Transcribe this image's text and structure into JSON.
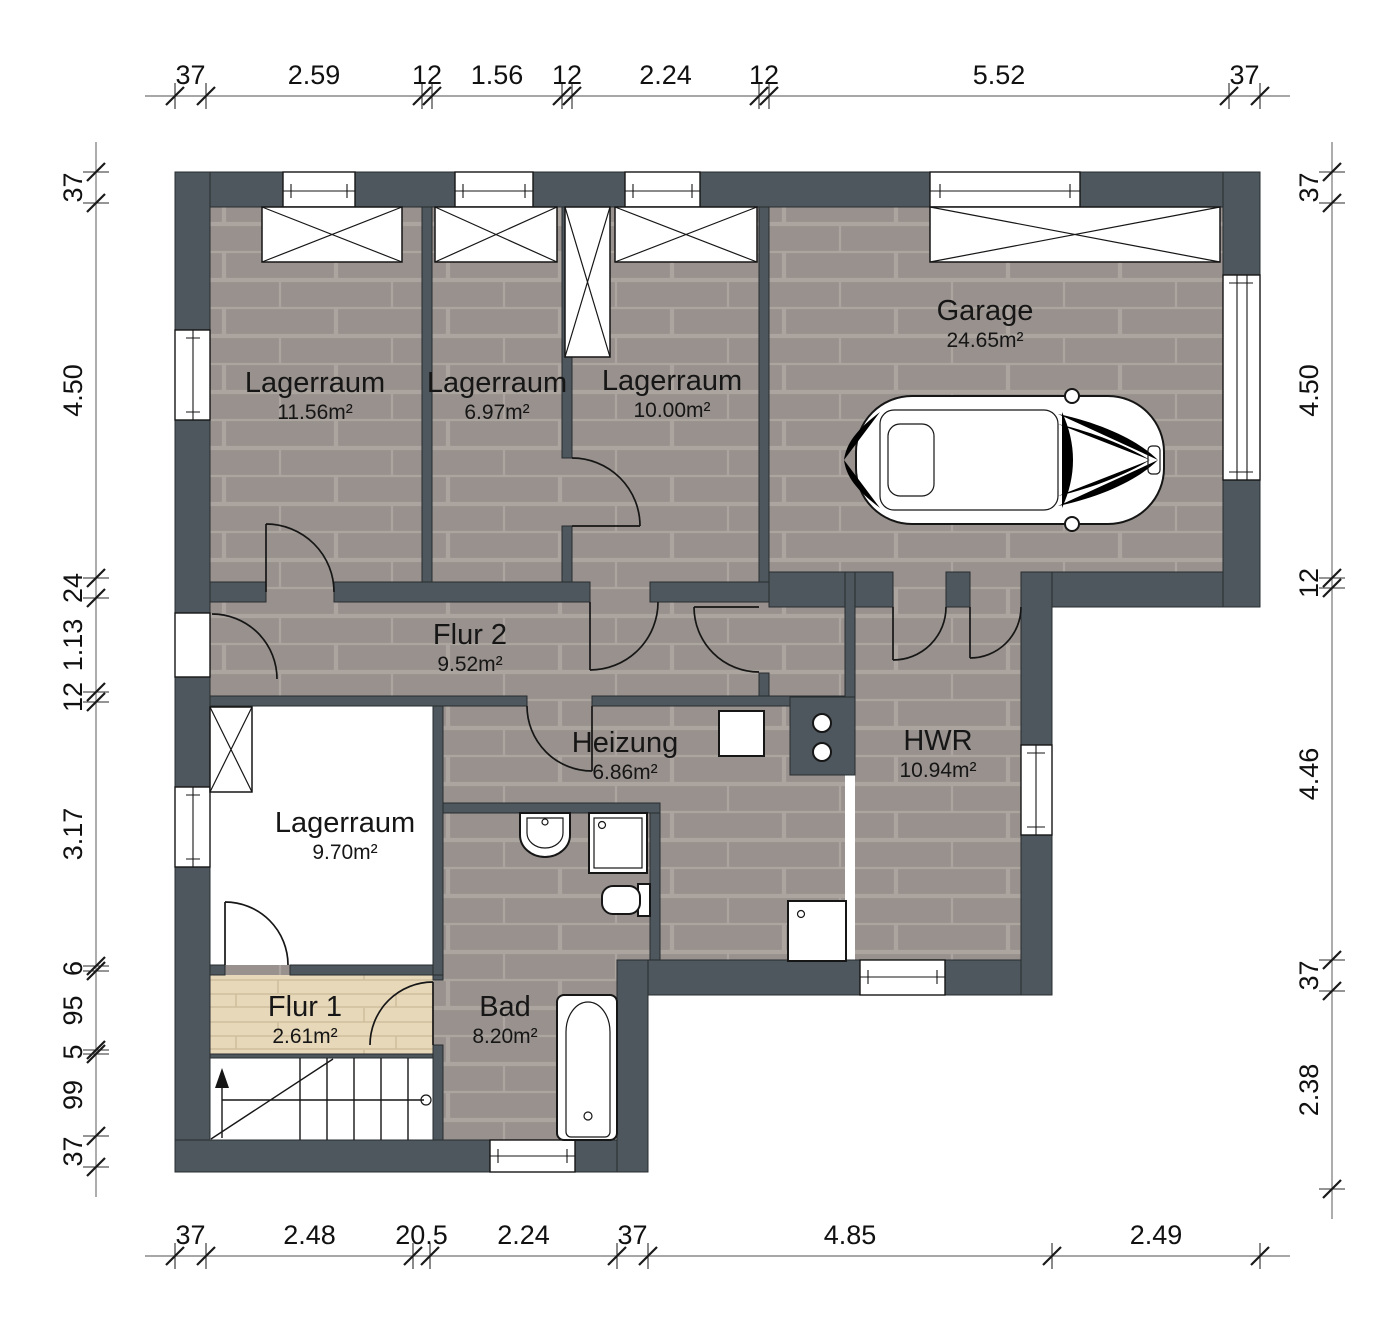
{
  "colors": {
    "wall": "#4e575d",
    "brick_base": "#98918d",
    "brick_joint": "#aca59f",
    "wood_base": "#e7d8ba",
    "wood_joint": "#d0bf9e",
    "outline": "#161616",
    "background": "#ffffff"
  },
  "plan": {
    "rooms": [
      {
        "id": "lagerraum-1",
        "name": "Lagerraum",
        "area": "11.56m²",
        "x": 315,
        "y": 392
      },
      {
        "id": "lagerraum-2",
        "name": "Lagerraum",
        "area": "6.97m²",
        "x": 497,
        "y": 392
      },
      {
        "id": "lagerraum-3",
        "name": "Lagerraum",
        "area": "10.00m²",
        "x": 672,
        "y": 390
      },
      {
        "id": "garage",
        "name": "Garage",
        "area": "24.65m²",
        "x": 985,
        "y": 320
      },
      {
        "id": "flur-2",
        "name": "Flur 2",
        "area": "9.52m²",
        "x": 470,
        "y": 644
      },
      {
        "id": "heizung",
        "name": "Heizung",
        "area": "6.86m²",
        "x": 625,
        "y": 752
      },
      {
        "id": "hwr",
        "name": "HWR",
        "area": "10.94m²",
        "x": 938,
        "y": 750
      },
      {
        "id": "lagerraum-4",
        "name": "Lagerraum",
        "area": "9.70m²",
        "x": 345,
        "y": 832
      },
      {
        "id": "flur-1",
        "name": "Flur 1",
        "area": "2.61m²",
        "x": 305,
        "y": 1016
      },
      {
        "id": "bad",
        "name": "Bad",
        "area": "8.20m²",
        "x": 505,
        "y": 1016
      }
    ],
    "fixture_icons": [
      "car-icon",
      "bathtub-icon",
      "sink-icon",
      "shower-icon",
      "toilet-icon",
      "washing-machine-icon",
      "heater-icon",
      "stairs-icon",
      "pipes-icon",
      "window-icon",
      "lintel-x-icon"
    ],
    "dimensions": {
      "top": {
        "orientation": "h",
        "line": 96,
        "ticks": [
          175,
          206,
          422,
          432,
          562,
          572,
          759,
          769,
          1229,
          1260
        ],
        "labels": [
          "37",
          "2.59",
          "12",
          "1.56",
          "12",
          "2.24",
          "12",
          "5.52",
          "37"
        ]
      },
      "bottom": {
        "orientation": "h",
        "line": 1256,
        "ticks": [
          175,
          206,
          413,
          430,
          617,
          648,
          1052,
          1260
        ],
        "labels": [
          "37",
          "2.48",
          "20.5",
          "2.24",
          "37",
          "4.85",
          "2.49"
        ]
      },
      "left": {
        "orientation": "v",
        "line": 96,
        "ticks": [
          172,
          203,
          578,
          598,
          692,
          702,
          966,
          971,
          1050,
          1054,
          1136,
          1167
        ],
        "labels": [
          "37",
          "4.50",
          "24",
          "1.13",
          "12",
          "3.17",
          "6",
          "95",
          "5",
          "99",
          "37"
        ]
      },
      "right": {
        "orientation": "v",
        "line": 1332,
        "ticks": [
          172,
          203,
          578,
          588,
          960,
          991,
          1189
        ],
        "labels": [
          "37",
          "4.50",
          "12",
          "4.46",
          "37",
          "2.38"
        ]
      }
    }
  }
}
